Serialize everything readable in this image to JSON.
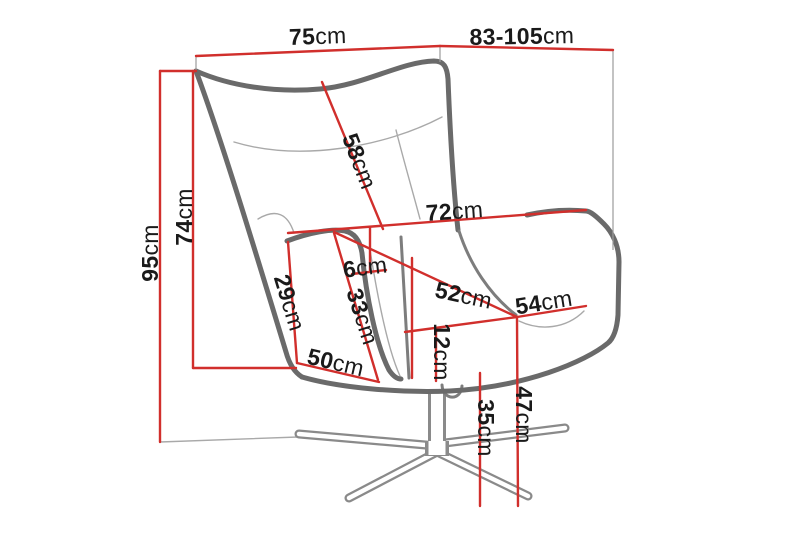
{
  "diagram": {
    "type": "furniture-dimension-diagram",
    "subject": "swivel wingback armchair",
    "unit": "cm",
    "colors": {
      "dimension_line": "#d12f2c",
      "chair_outline": "#6a6a6a",
      "seam_line": "#a9a9a9",
      "label_text": "#1a1a1a",
      "background": "#ffffff"
    },
    "dimensions": [
      {
        "id": "total-width",
        "value": "75",
        "unit": "cm"
      },
      {
        "id": "total-depth",
        "value": "83-105",
        "unit": "cm"
      },
      {
        "id": "total-height",
        "value": "95",
        "unit": "cm"
      },
      {
        "id": "backrest-height",
        "value": "74",
        "unit": "cm"
      },
      {
        "id": "backrest-length",
        "value": "58",
        "unit": "cm"
      },
      {
        "id": "depth-at-armrest",
        "value": "72",
        "unit": "cm"
      },
      {
        "id": "armrest-top-width",
        "value": "6",
        "unit": "cm"
      },
      {
        "id": "armrest-front-height",
        "value": "29",
        "unit": "cm"
      },
      {
        "id": "armrest-inner-height",
        "value": "33",
        "unit": "cm"
      },
      {
        "id": "seat-front-width",
        "value": "50",
        "unit": "cm"
      },
      {
        "id": "seat-width",
        "value": "52",
        "unit": "cm"
      },
      {
        "id": "seat-depth",
        "value": "54",
        "unit": "cm"
      },
      {
        "id": "seat-thickness",
        "value": "12",
        "unit": "cm"
      },
      {
        "id": "underseat-height",
        "value": "35",
        "unit": "cm"
      },
      {
        "id": "seat-height",
        "value": "47",
        "unit": "cm"
      }
    ]
  }
}
